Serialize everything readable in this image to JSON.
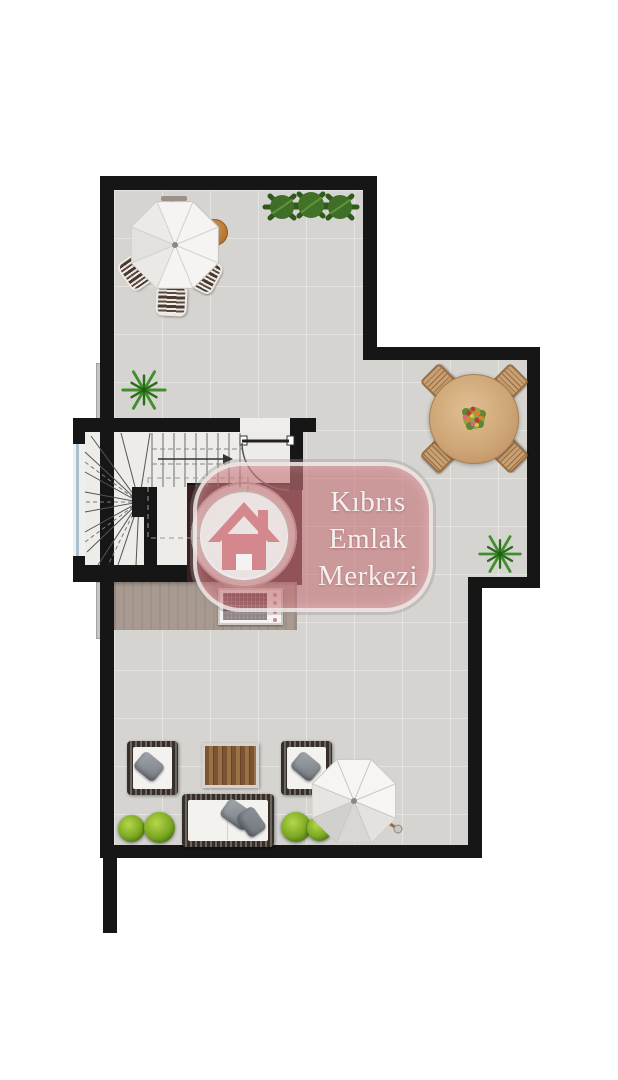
{
  "watermark": {
    "line1": "Kıbrıs",
    "line2": "Emlak",
    "line3": "Merkezi"
  },
  "colors": {
    "floor": "#d6d4d1",
    "grid": "#e6e4e1",
    "wall": "#161616",
    "deck": "#a89a90",
    "platform": "#3a1e20",
    "stairfloor": "#edece8",
    "brand-pink": "rgba(199,116,121,0.62)",
    "logo-pink": "#d4878d",
    "brand-text": "#f3f0ed",
    "wood": "#cfa676",
    "wood-dark": "#9a6f42",
    "green": "#4a7714",
    "umbrella": "#f6f5f3"
  }
}
